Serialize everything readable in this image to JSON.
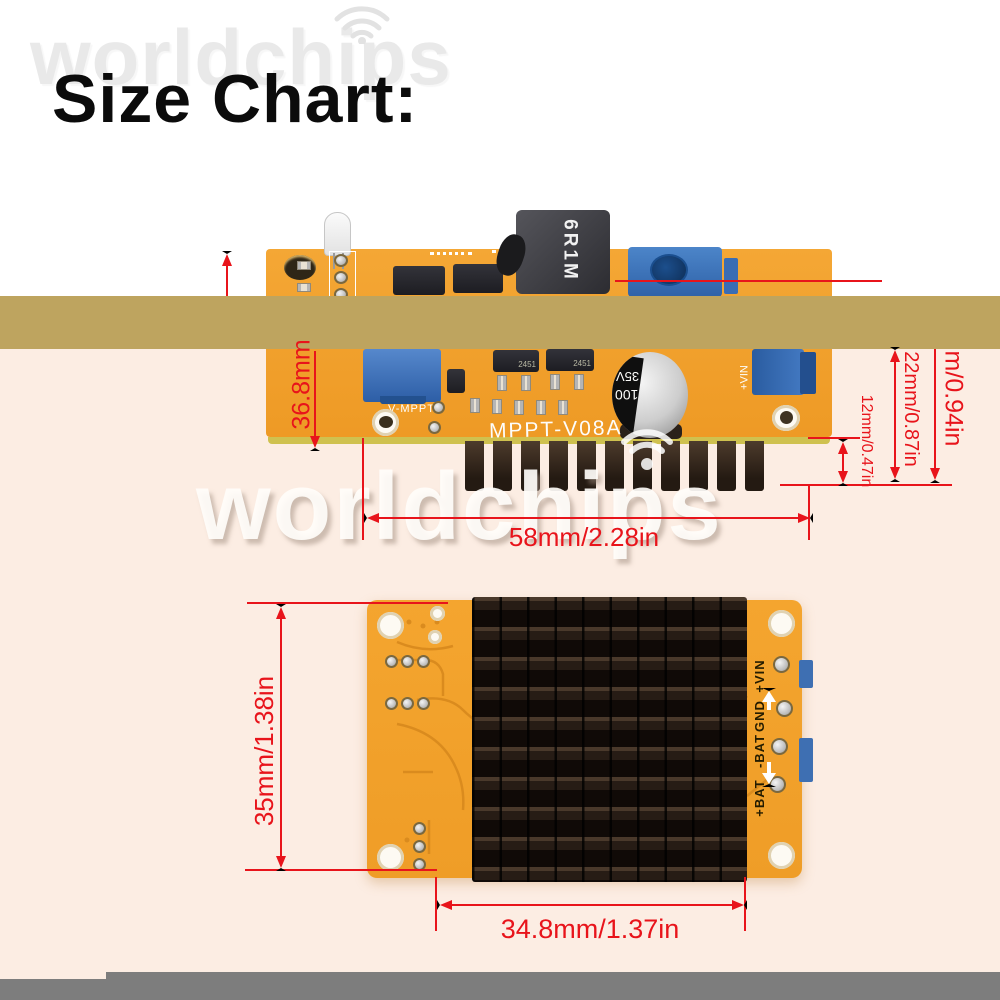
{
  "title": "Size Chart:",
  "watermark": {
    "brand": "worldchips"
  },
  "colors": {
    "dimension_red": "#e8141b",
    "band_tan": "#bea45f",
    "background_pink": "#fcede3",
    "pcb_orange": "#f3a02c",
    "footer_gray": "#7d7d7d"
  },
  "top_view": {
    "silkscreen_model": "MPPT-V08A",
    "trimmer_label": "V-MPPT",
    "vin_label": "+VIN",
    "inductor_marking": "6R1M",
    "capacitor_marking": {
      "capacitance": "100",
      "voltage": "35V"
    },
    "chip_marking": "2451",
    "dimensions": {
      "board_height": "36.8mm",
      "overall_height": "m/0.94in",
      "component_height": "22mm/0.87in",
      "heatsink_fin_height": "12mm/0.47in",
      "board_width": "58mm/2.28in"
    }
  },
  "bottom_view": {
    "pin_labels": [
      "+VIN",
      "GND",
      "-BAT",
      "+BAT"
    ],
    "dimensions": {
      "board_height": "35mm/1.38in",
      "heatsink_width": "34.8mm/1.37in"
    }
  }
}
